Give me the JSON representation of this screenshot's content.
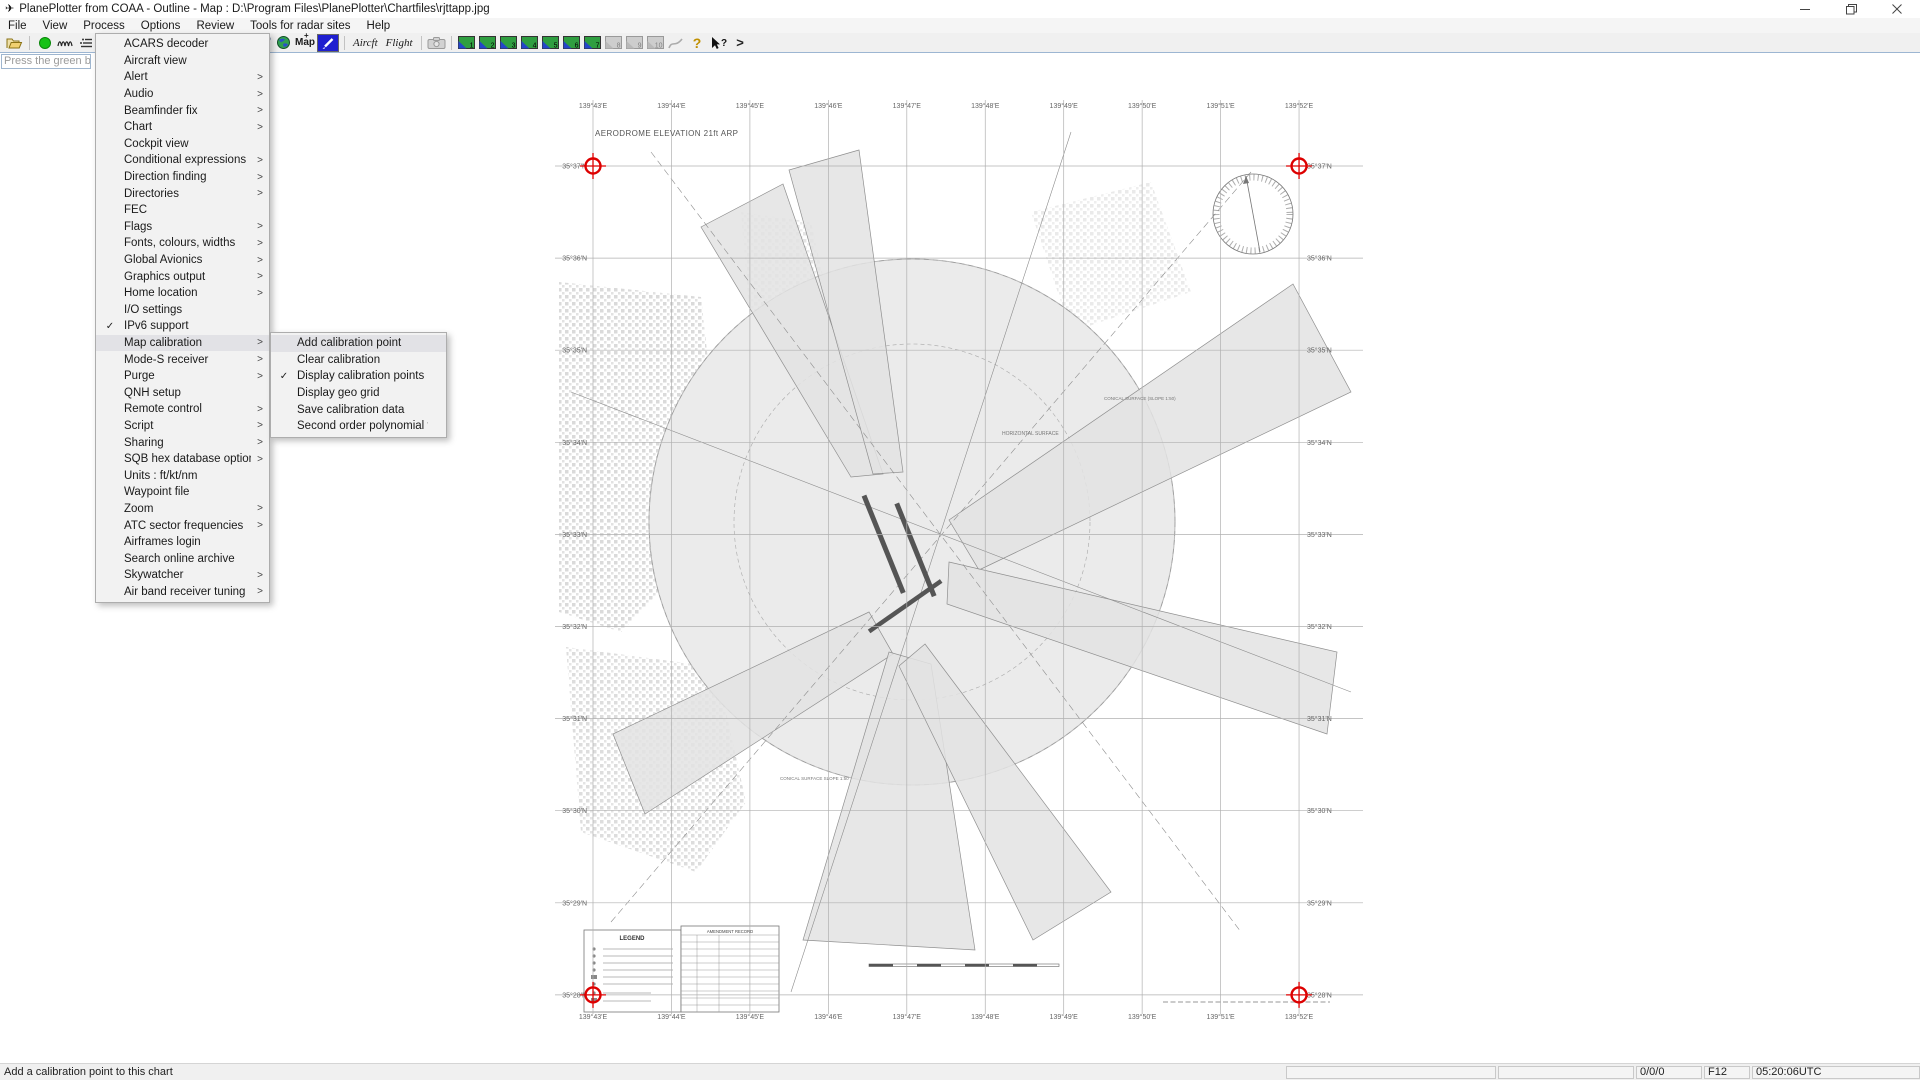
{
  "window": {
    "title": "PlanePlotter from COAA - Outline - Map : D:\\Program Files\\PlanePlotter\\Chartfiles\\rjttapp.jpg",
    "controls": [
      "minimize",
      "restore",
      "close"
    ]
  },
  "menu_bar": {
    "items": [
      "File",
      "View",
      "Process",
      "Options",
      "Review",
      "Tools for radar sites",
      "Help"
    ],
    "open_item": "Options"
  },
  "toolbar": {
    "icons_left": [
      "open-file-icon",
      "record-icon",
      "signal-trace-icon",
      "signal-levels-icon"
    ],
    "icons_right": [
      "io-setup-wrench-icon",
      "globe-icon",
      "map-button",
      "draw-pencil-button",
      "aircft-button",
      "flight-button",
      "camera-button",
      "chart-buttons-1-10",
      "draw-disabled-icon",
      "help-icon",
      "context-help-icon",
      "more-tools-chevron"
    ],
    "map_label": "Map",
    "aircft_label": "Aircft",
    "flight_label": "Flight",
    "chart_buttons": [
      {
        "label": "1",
        "enabled": true
      },
      {
        "label": "2",
        "enabled": true
      },
      {
        "label": "3",
        "enabled": true
      },
      {
        "label": "4",
        "enabled": true
      },
      {
        "label": "5",
        "enabled": true
      },
      {
        "label": "6",
        "enabled": true
      },
      {
        "label": "7",
        "enabled": true
      },
      {
        "label": "8",
        "enabled": false
      },
      {
        "label": "9",
        "enabled": false
      },
      {
        "label": "10",
        "enabled": false
      }
    ]
  },
  "hint_box": {
    "text": "Press the green b"
  },
  "options_menu": {
    "items": [
      {
        "label": "ACARS decoder"
      },
      {
        "label": "Aircraft view"
      },
      {
        "label": "Alert",
        "arrow": true
      },
      {
        "label": "Audio",
        "arrow": true
      },
      {
        "label": "Beamfinder fix",
        "arrow": true
      },
      {
        "label": "Chart",
        "arrow": true
      },
      {
        "label": "Cockpit view"
      },
      {
        "label": "Conditional expressions",
        "arrow": true
      },
      {
        "label": "Direction finding",
        "arrow": true
      },
      {
        "label": "Directories",
        "arrow": true
      },
      {
        "label": "FEC"
      },
      {
        "label": "Flags",
        "arrow": true
      },
      {
        "label": "Fonts, colours,  widths",
        "arrow": true
      },
      {
        "label": "Global Avionics",
        "arrow": true
      },
      {
        "label": "Graphics output",
        "arrow": true
      },
      {
        "label": "Home location",
        "arrow": true
      },
      {
        "label": "I/O settings"
      },
      {
        "label": "IPv6 support",
        "checked": true
      },
      {
        "label": "Map calibration",
        "arrow": true,
        "highlighted": true
      },
      {
        "label": "Mode-S receiver",
        "arrow": true
      },
      {
        "label": "Purge",
        "arrow": true
      },
      {
        "label": "QNH setup"
      },
      {
        "label": "Remote control",
        "arrow": true
      },
      {
        "label": "Script",
        "arrow": true
      },
      {
        "label": "Sharing",
        "arrow": true
      },
      {
        "label": "SQB hex database options",
        "arrow": true
      },
      {
        "label": "Units : ft/kt/nm"
      },
      {
        "label": "Waypoint file"
      },
      {
        "label": "Zoom",
        "arrow": true
      },
      {
        "label": "ATC sector frequencies",
        "arrow": true
      },
      {
        "label": "Airframes login"
      },
      {
        "label": "Search online archive"
      },
      {
        "label": "Skywatcher",
        "arrow": true
      },
      {
        "label": "Air band receiver tuning",
        "arrow": true
      }
    ]
  },
  "submenu": {
    "items": [
      {
        "label": "Add calibration point",
        "highlighted": true
      },
      {
        "label": "Clear calibration"
      },
      {
        "label": "Display calibration points",
        "checked": true
      },
      {
        "label": "Display geo grid"
      },
      {
        "label": "Save calibration data"
      },
      {
        "label": "Second order polynomial fit"
      }
    ]
  },
  "chart": {
    "annotations": {
      "elevation": "AERODROME ELEVATION 21ft ARP",
      "horizontal_surface": "HORIZONTAL SURFACE",
      "conical_surface_a": "CONICAL SURFACE (SLOPE 1:50)",
      "conical_surface_b": "CONICAL SURFACE SLOPE 1:50",
      "legend_title": "LEGEND",
      "amendment_title": "AMENDMENT RECORD"
    },
    "longitude_labels": [
      "139°43'E",
      "139°44'E",
      "139°45'E",
      "139°46'E",
      "139°47'E",
      "139°48'E",
      "139°49'E",
      "139°50'E",
      "139°51'E",
      "139°52'E"
    ],
    "latitude_labels": [
      "35°37'N",
      "35°36'N",
      "35°35'N",
      "35°34'N",
      "35°33'N",
      "35°32'N",
      "35°31'N",
      "35°30'N",
      "35°29'N",
      "35°28'N"
    ],
    "calibration_marker_color": "#dd0000"
  },
  "status_bar": {
    "message": "Add a calibration point to this chart",
    "cell_empty_1": "",
    "cell_empty_2": "",
    "counts": "0/0/0",
    "key": "F12",
    "time": "05:20:06UTC"
  }
}
